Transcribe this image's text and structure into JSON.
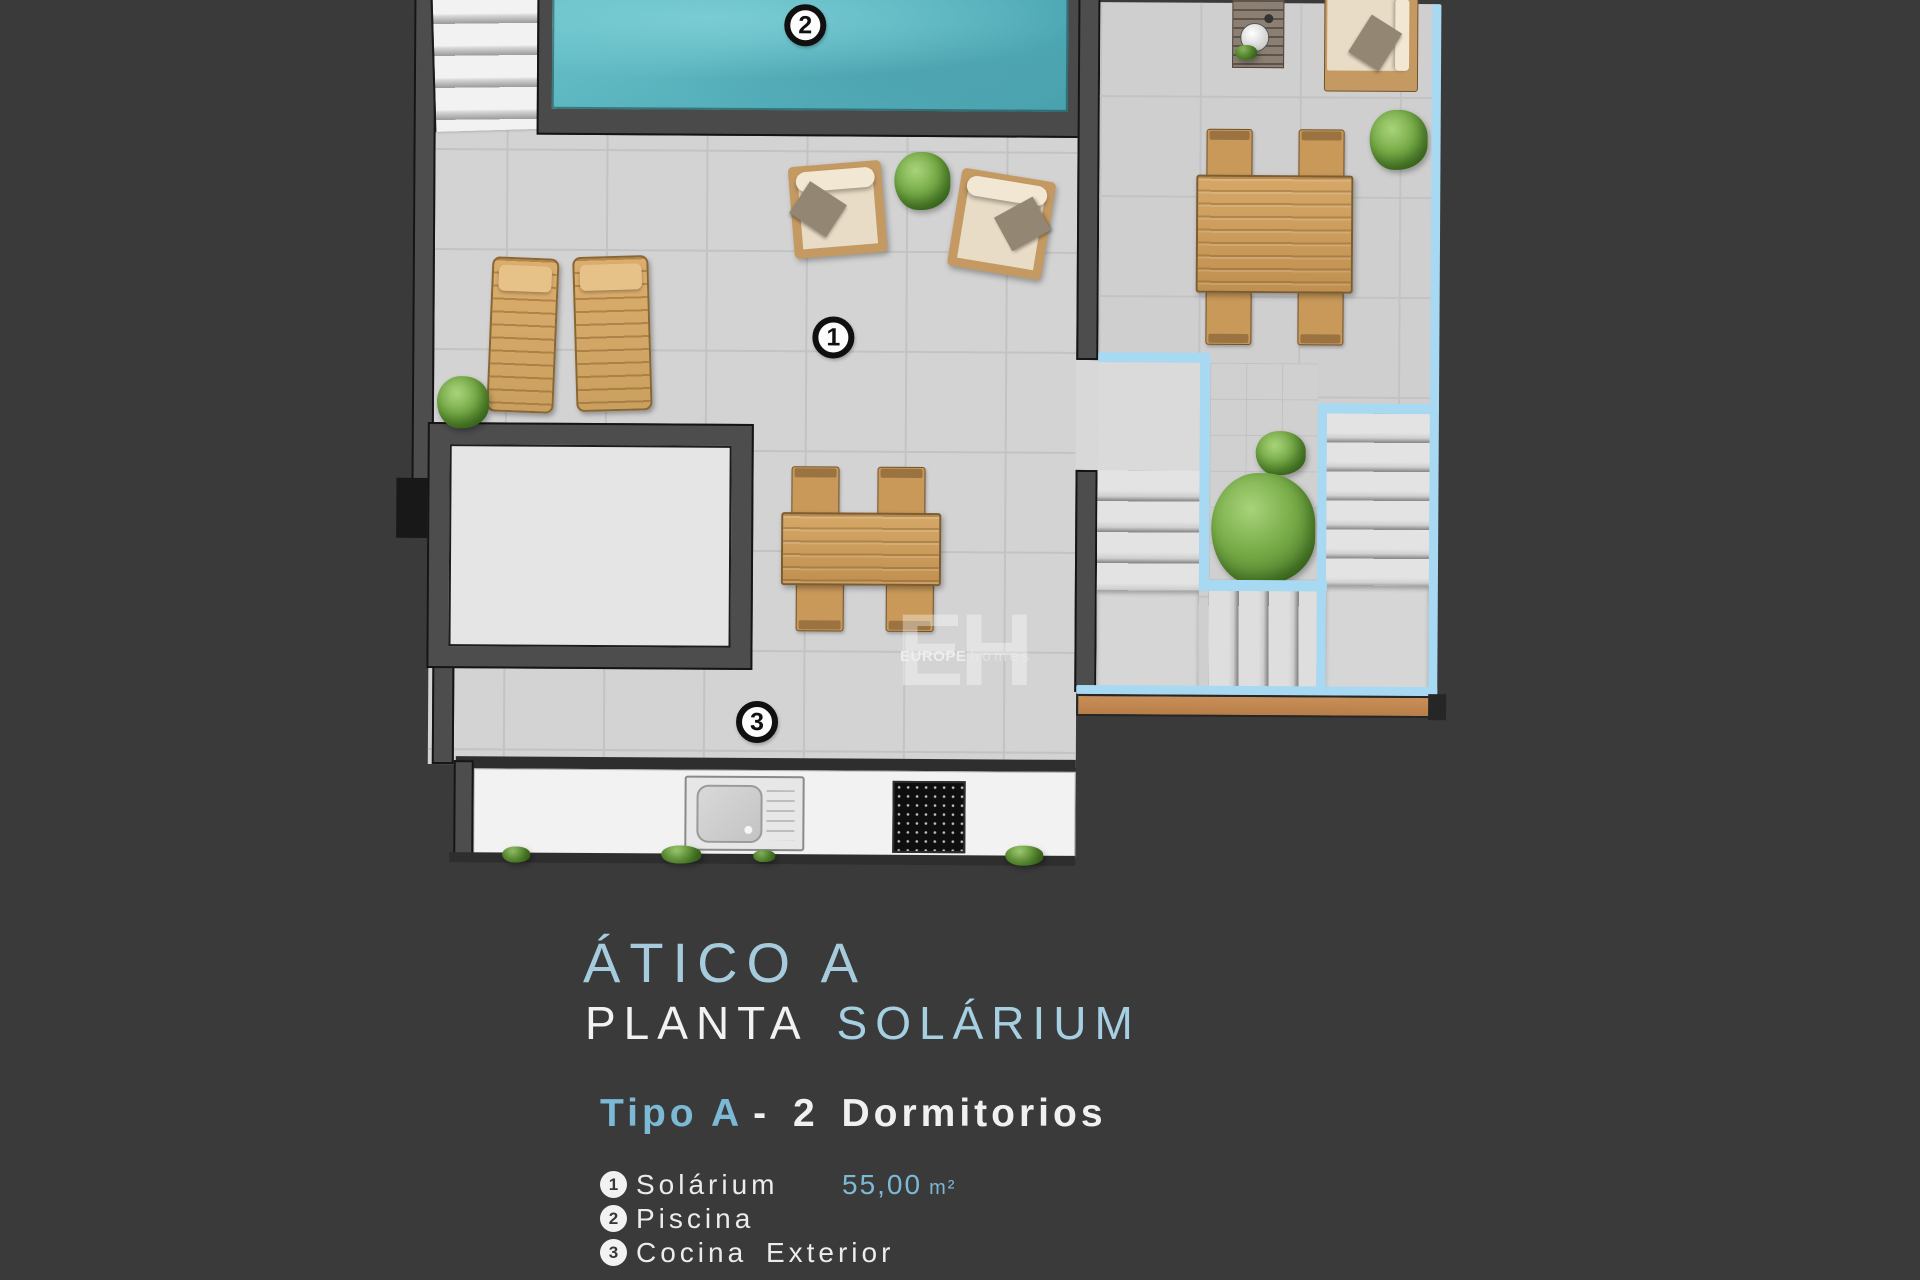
{
  "page": {
    "background": "#3a3a3a"
  },
  "colors": {
    "accent_blue": "#7cb9d4",
    "title_blue": "#a6cbdd",
    "lower_level_outline_blue": "#a7d9f2",
    "pool_water_teal": "#5cb6c0",
    "wood_tan": "#c9995a",
    "deck_tile_gray": "#d3d3d3"
  },
  "plan": {
    "markers": {
      "solarium": "1",
      "piscina": "2",
      "cocina": "3"
    },
    "watermark": {
      "initials": "EH",
      "brand_bold": "EUROPE",
      "brand_light": "homes"
    }
  },
  "title_block": {
    "project": "ÁTICO A",
    "floor_white": "PLANTA",
    "floor_blue": "SOLÁRIUM",
    "type_blue": "Tipo A",
    "type_white": "- 2 Dormitorios"
  },
  "legend": {
    "items": [
      {
        "num": "1",
        "label": "Solárium",
        "area": "55,00",
        "unit": "m²"
      },
      {
        "num": "2",
        "label": "Piscina",
        "area": "",
        "unit": ""
      },
      {
        "num": "3",
        "label": "Cocina Exterior",
        "area": "",
        "unit": ""
      }
    ]
  }
}
